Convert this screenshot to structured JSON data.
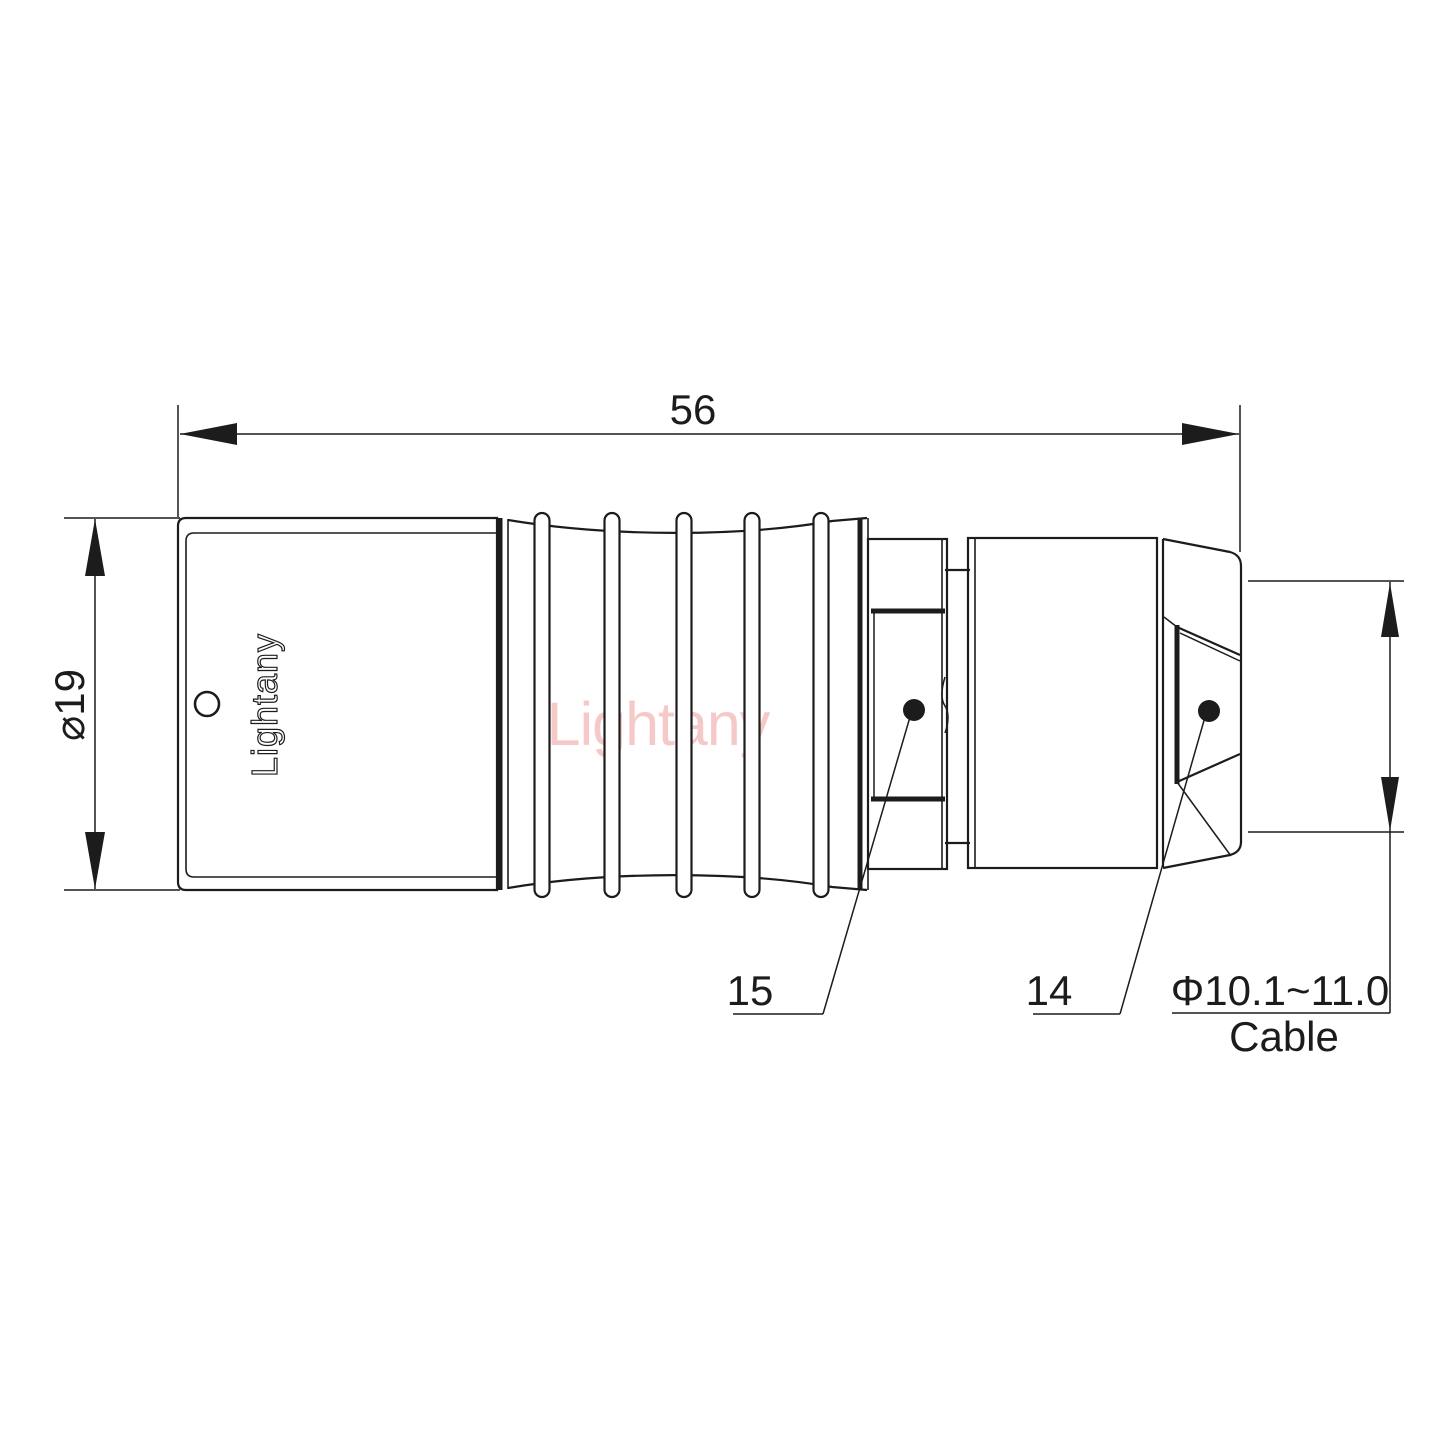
{
  "drawing": {
    "dimensions": {
      "overall_length": {
        "value": "56"
      },
      "shell_diameter": {
        "value": "⌀19"
      },
      "cable": {
        "range": "Φ10.1~11.0",
        "label": "Cable"
      }
    },
    "part_labels": {
      "sleeve": "15",
      "nut": "14"
    },
    "branding": {
      "shell_text": "Lightany",
      "watermark_text": "Lightany"
    },
    "colors": {
      "line": "#1c1c1c",
      "watermark": "#f5bcbc",
      "background": "#ffffff"
    }
  }
}
